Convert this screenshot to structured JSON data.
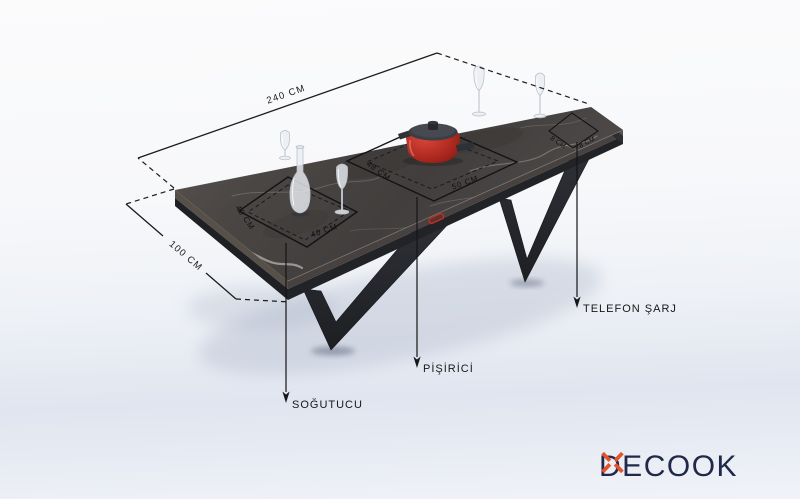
{
  "dimensions": {
    "length": "240 CM",
    "width": "100 CM"
  },
  "zones": {
    "cooler": {
      "callout": "SOĞUTUCU",
      "side": "40 CM",
      "front": "40 CM"
    },
    "cooker": {
      "callout": "PİŞİRİCİ",
      "side": "48 CM",
      "front": "50 CM"
    },
    "charger": {
      "callout": "TELEFON ŞARJ",
      "left": "8 CM",
      "right": "8 CM"
    }
  },
  "logo": {
    "prefix": "DE",
    "suffix": "COOK"
  },
  "colors": {
    "annotation": "#17171a",
    "logo_text": "#20294a",
    "logo_x": "#e5512a",
    "pot_body": "#b02a20",
    "marble_top": "#45423f",
    "frame_dark": "#24262a"
  }
}
